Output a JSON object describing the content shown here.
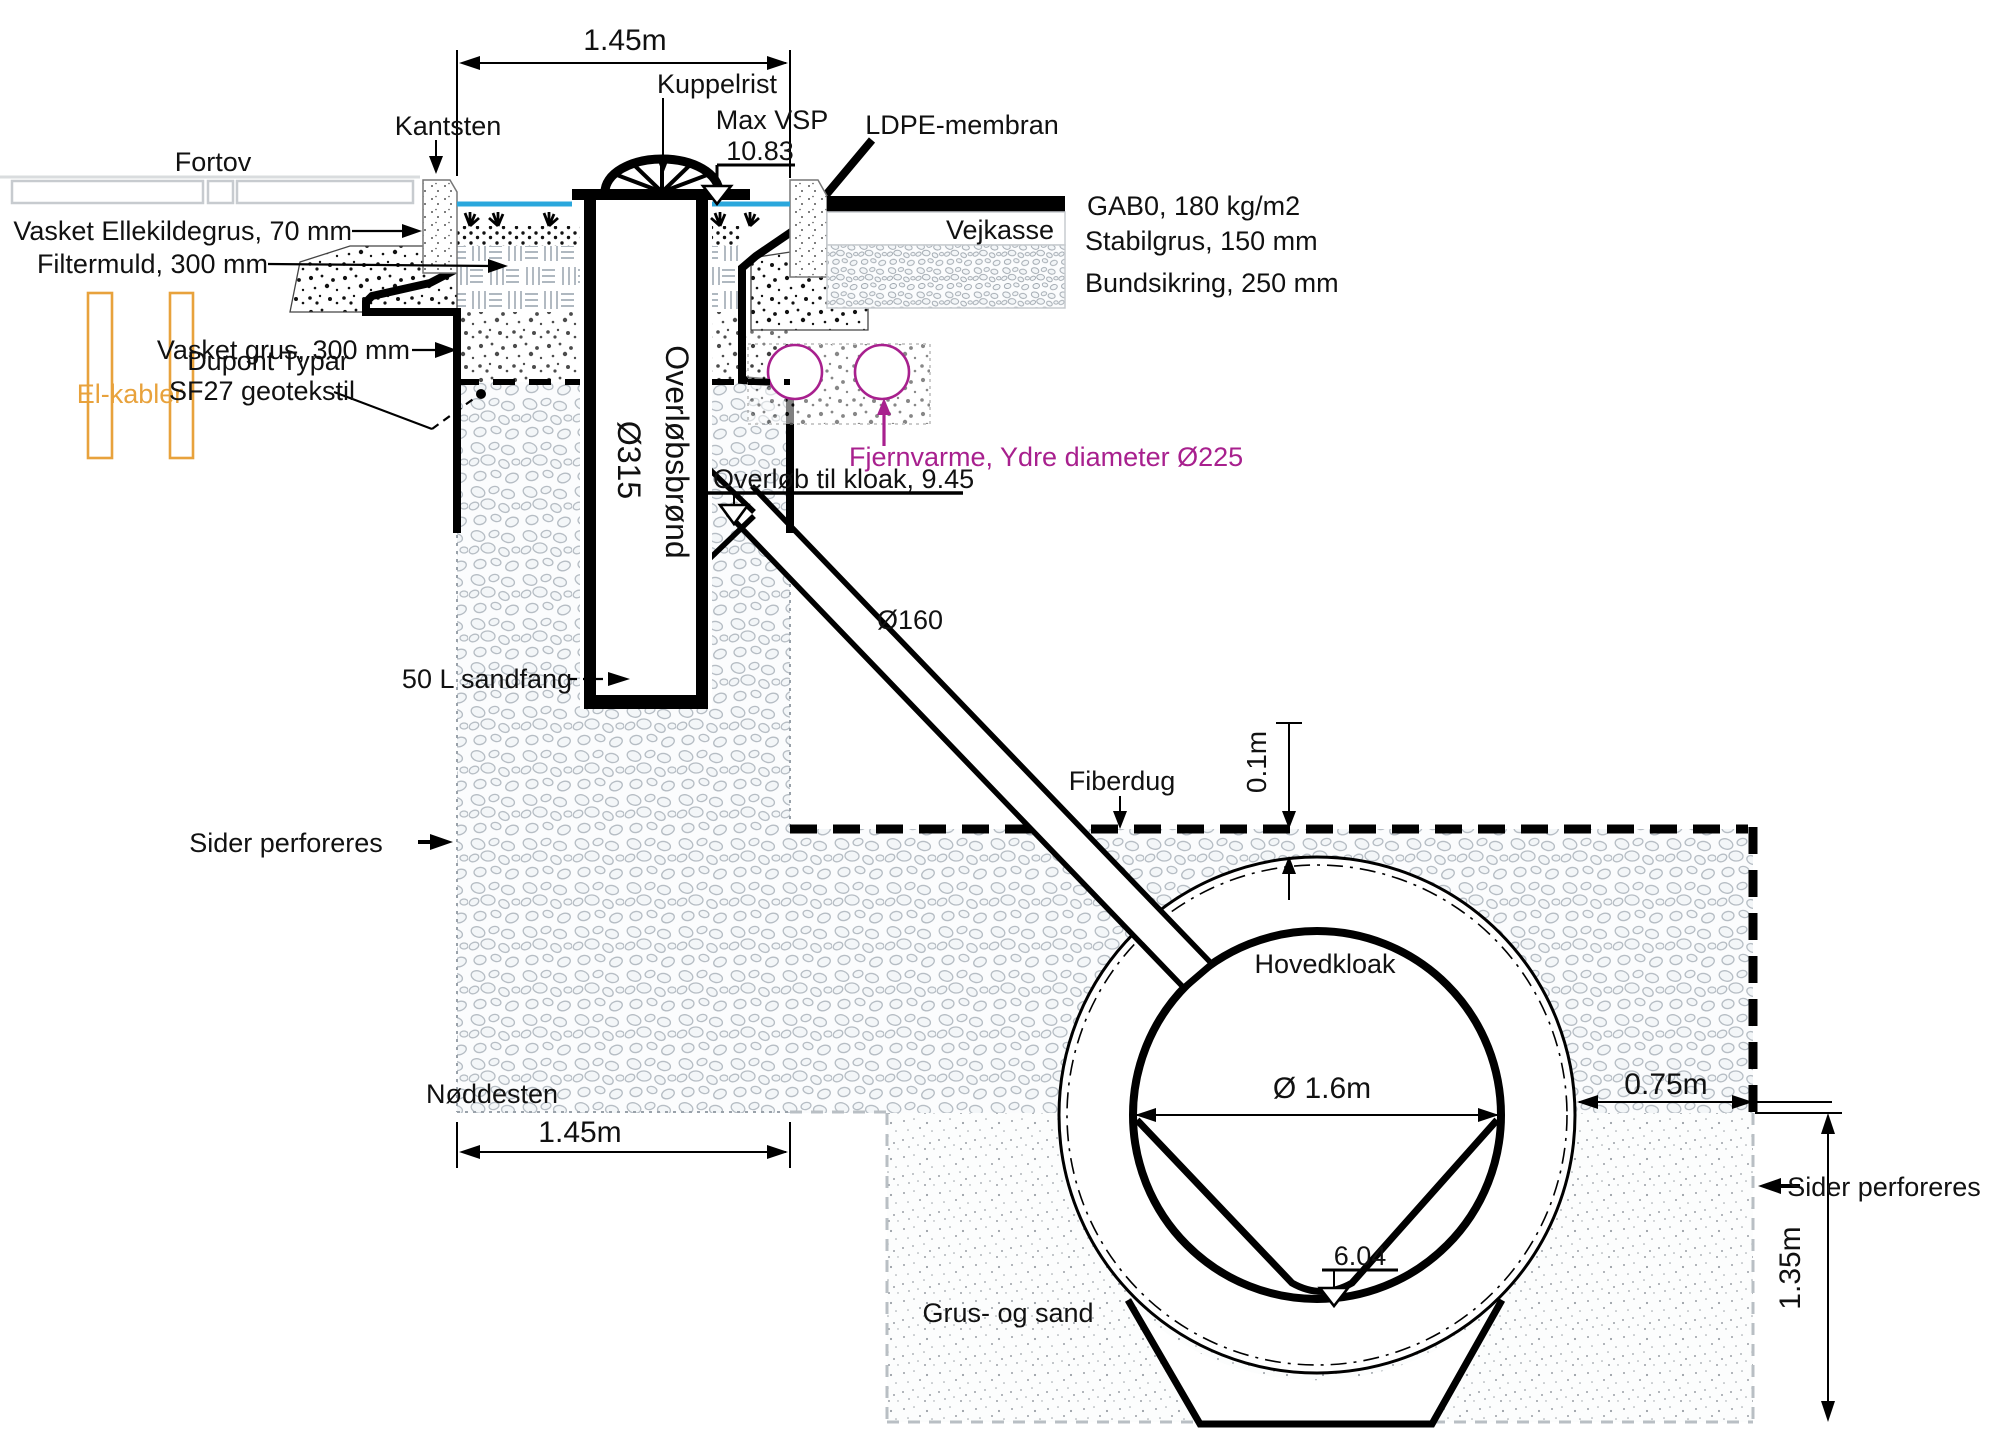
{
  "colors": {
    "water_line": "#2AA7DC",
    "district_heating": "#A8208E",
    "el_cables": "#E8A23C",
    "ink": "#000000"
  },
  "surface": {
    "sidewalk_label": "Fortov",
    "curb_label": "Kantsten",
    "grate_label": "Kuppelrist",
    "max_water_level_label": "Max VSP",
    "max_water_level_value": "10.83",
    "membrane_label": "LDPE-membran"
  },
  "road": {
    "name": "Vejkasse",
    "asphalt_layer": "GAB0, 180 kg/m2",
    "base_layer": "Stabilgrus, 150 mm",
    "subbase_layer": "Bundsikring, 250 mm"
  },
  "trench_layers": {
    "top_gravel": "Vasket Ellekildegrus, 70 mm",
    "filter_soil": "Filtermuld, 300 mm",
    "washed_gravel": "Vasket grus, 300 mm",
    "geotextile_line1": "Dupont Typar",
    "geotextile_line2": "SF27 geotekstil",
    "stone_fill": "Nøddesten",
    "perforation_left": "Sider perforeres",
    "el_cables": "El-kabler"
  },
  "well": {
    "diameter": "Ø315",
    "name": "Overløbsbrønd",
    "sand_trap": "50 L sandfang",
    "overflow_invert": "Overløb til kloak, 9.45"
  },
  "district_heating": {
    "label": "Fjernvarme, Ydre diameter Ø225"
  },
  "overflow_pipe": {
    "diameter": "Ø160"
  },
  "main_sewer": {
    "fabric": "Fiberdug",
    "cover_gap": "0.1m",
    "name": "Hovedkloak",
    "inner_diameter": "Ø 1.6m",
    "invert_level": "6.04",
    "bedding": "Grus- og sand",
    "side_clearance": "0.75m",
    "perforation_right": "Sider perforeres",
    "depth_below": "1.35m"
  },
  "dimensions": {
    "trench_width_top": "1.45m",
    "trench_width_bottom": "1.45m"
  }
}
